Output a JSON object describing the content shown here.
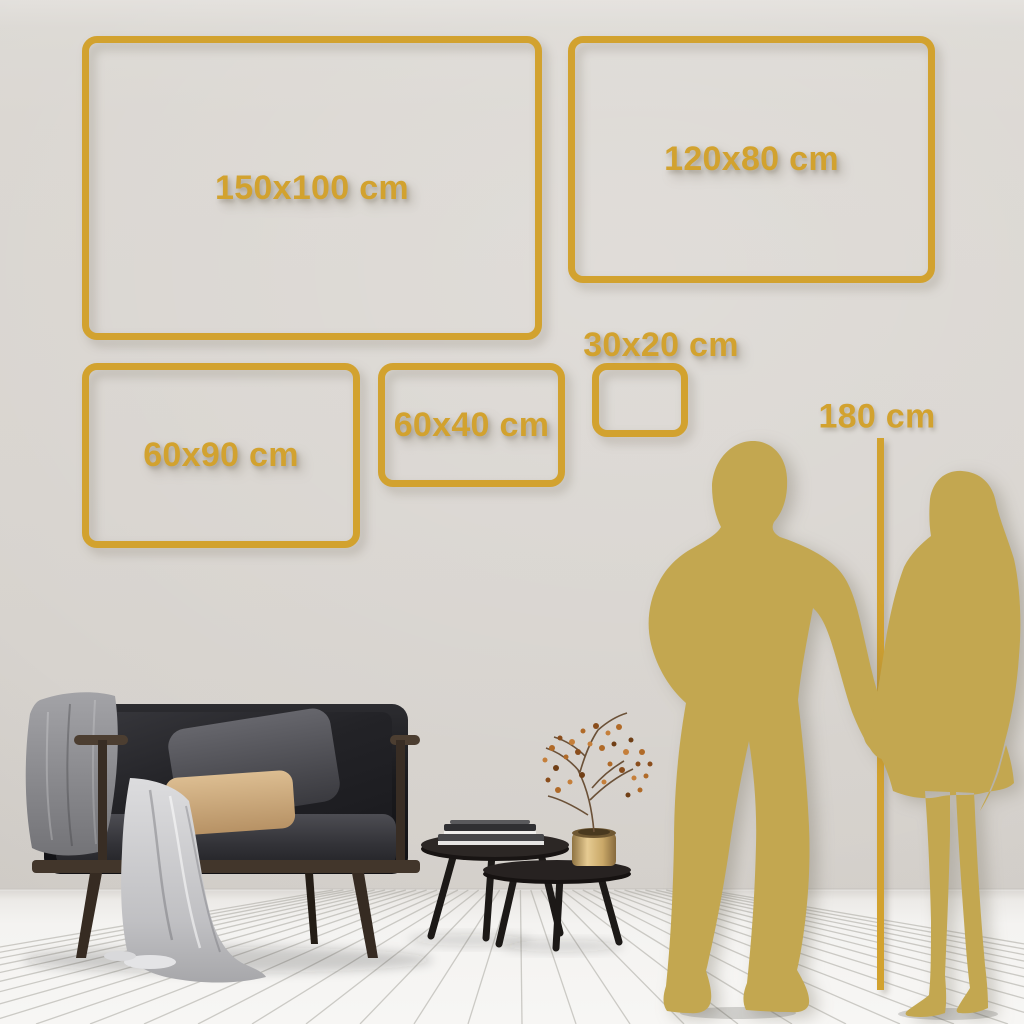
{
  "sizes": [
    {
      "label": "150x100 cm",
      "x": 82,
      "y": 36,
      "w": 460,
      "h": 304,
      "label_inside": true
    },
    {
      "label": "120x80 cm",
      "x": 568,
      "y": 36,
      "w": 367,
      "h": 247,
      "label_inside": true
    },
    {
      "label": "60x90 cm",
      "x": 82,
      "y": 363,
      "w": 278,
      "h": 185,
      "label_inside": true
    },
    {
      "label": "60x40 cm",
      "x": 378,
      "y": 363,
      "w": 187,
      "h": 124,
      "label_inside": true
    },
    {
      "label": "30x20 cm",
      "x": 592,
      "y": 363,
      "w": 96,
      "h": 74,
      "label_inside": false,
      "label_dx": 21
    }
  ],
  "height_marker": {
    "label": "180 cm",
    "x": 877,
    "w": 7,
    "top": 438,
    "bottom": 990,
    "label_cx": 877,
    "label_cy": 417
  },
  "colors": {
    "frame_gold": "#d2a22f",
    "silhouette_gold": "#c3a750",
    "wall": "#d8d4cf",
    "floor": "#f5f4f2"
  }
}
